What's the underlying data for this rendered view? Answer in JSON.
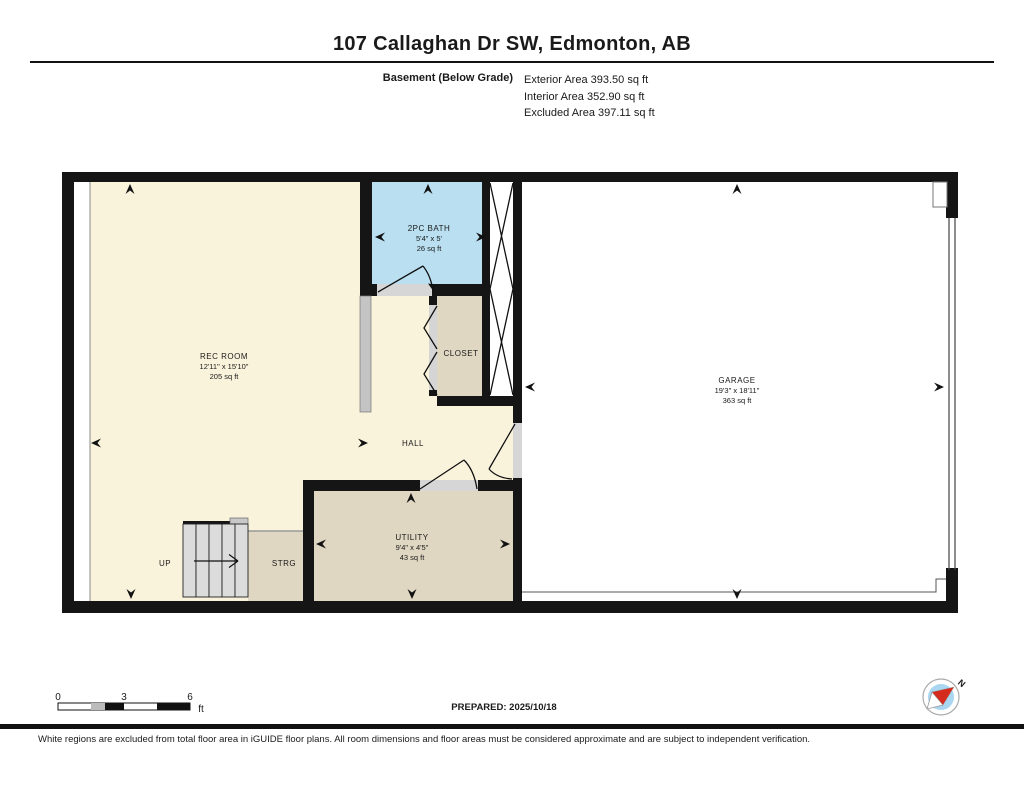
{
  "title": "107 Callaghan Dr SW, Edmonton, AB",
  "floor_info": {
    "floor_label": "Basement (Below Grade)",
    "exterior_area": "Exterior Area 393.50 sq ft",
    "interior_area": "Interior Area 352.90 sq ft",
    "excluded_area": "Excluded Area 397.11 sq ft"
  },
  "rooms": {
    "rec_room": {
      "name": "REC ROOM",
      "dims": "12'11\" x 15'10\"",
      "area": "205 sq ft"
    },
    "bath": {
      "name": "2PC BATH",
      "dims": "5'4\" x 5'",
      "area": "26 sq ft"
    },
    "closet": {
      "name": "CLOSET"
    },
    "hall": {
      "name": "HALL"
    },
    "garage": {
      "name": "GARAGE",
      "dims": "19'3\" x 18'11\"",
      "area": "363 sq ft"
    },
    "utility": {
      "name": "UTILITY",
      "dims": "9'4\" x 4'5\"",
      "area": "43 sq ft"
    },
    "strg": {
      "name": "STRG"
    },
    "stairs": {
      "name": "UP"
    }
  },
  "scale_bar": {
    "tick0": "0",
    "tick3": "3",
    "tick6": "6",
    "unit": "ft"
  },
  "prepared": "PREPARED: 2025/10/18",
  "compass": {
    "north_label": "N"
  },
  "footer": "White regions are excluded from total floor area in iGUIDE floor plans. All room dimensions and floor areas must be considered approximate and are subject to independent verification.",
  "colors": {
    "room_cream": "#FAF3DC",
    "bath_blue": "#B9DFF1",
    "tan": "#E0D7C3",
    "wall_black": "#151515",
    "compass_blue": "#A9D6F0",
    "compass_red": "#D42B1E",
    "garage_white": "#FFFFFF"
  }
}
